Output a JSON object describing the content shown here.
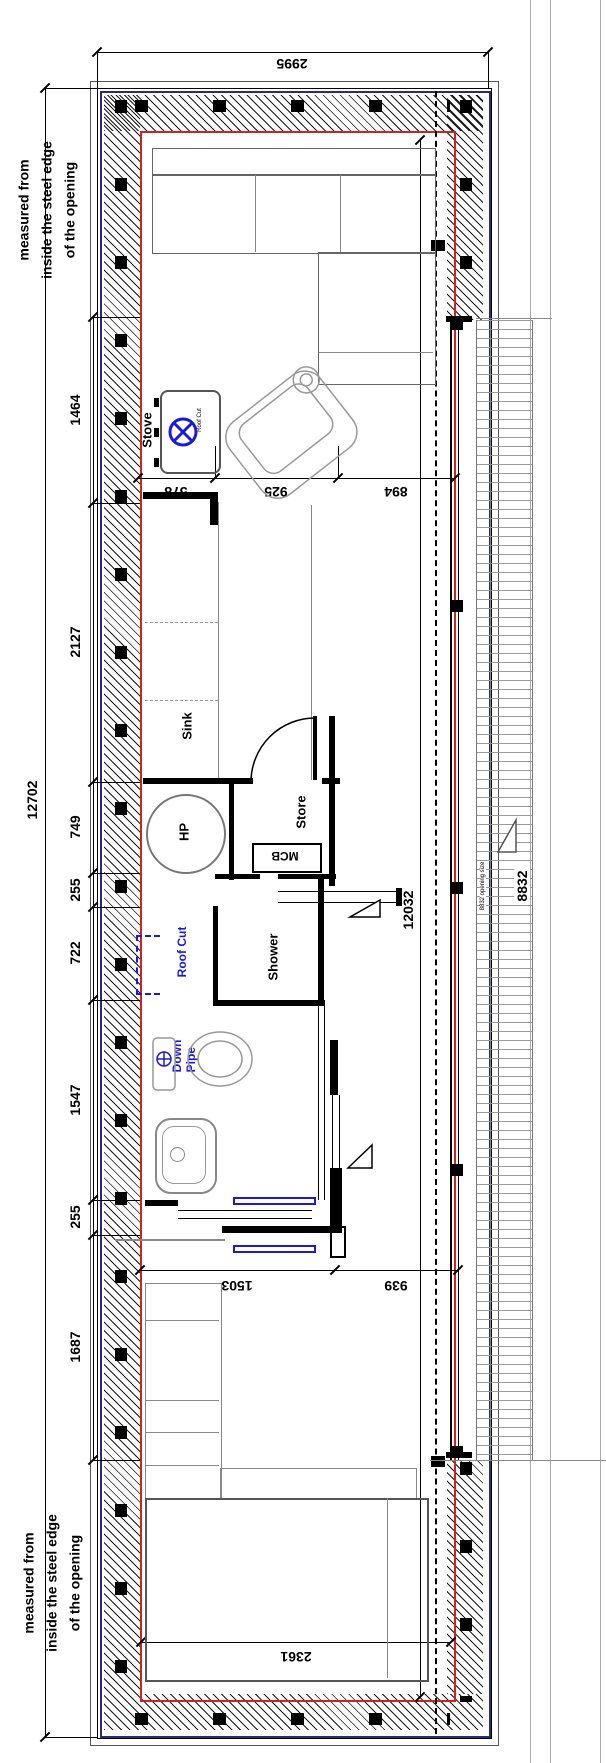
{
  "side_notes": {
    "top": [
      "measured from",
      "inside the steel edge",
      "of the opening"
    ],
    "bottom": [
      "measured from",
      "inside the steel edge",
      "of the opening"
    ]
  },
  "dimensions": {
    "overall_width": "2995",
    "overall_length": "12702",
    "internal_length": "12032",
    "glazed_opening": "8832",
    "glazed_opening_note": "8832 opening size",
    "left_chain": [
      "1464",
      "2127",
      "749",
      "255",
      "722",
      "1547",
      "255",
      "1687"
    ],
    "stove_chain": [
      "578",
      "925",
      "894"
    ],
    "bathroom_chain": [
      "1503",
      "939"
    ],
    "bed_width": "2361"
  },
  "labels": {
    "stove": "Stove",
    "stove_roof_cut": "Roof Cut",
    "sink": "Sink",
    "hp": "HP",
    "store": "Store",
    "mcb": "MCB",
    "shower": "Shower",
    "roof_cut": "Roof Cut",
    "down_pipe_line1": "Down",
    "down_pipe_line2": "Pipe"
  },
  "colors": {
    "wall_outline_navy": "#2a2a7a",
    "inner_face_red": "#d42020",
    "annotation_blue": "#1a1adf"
  }
}
